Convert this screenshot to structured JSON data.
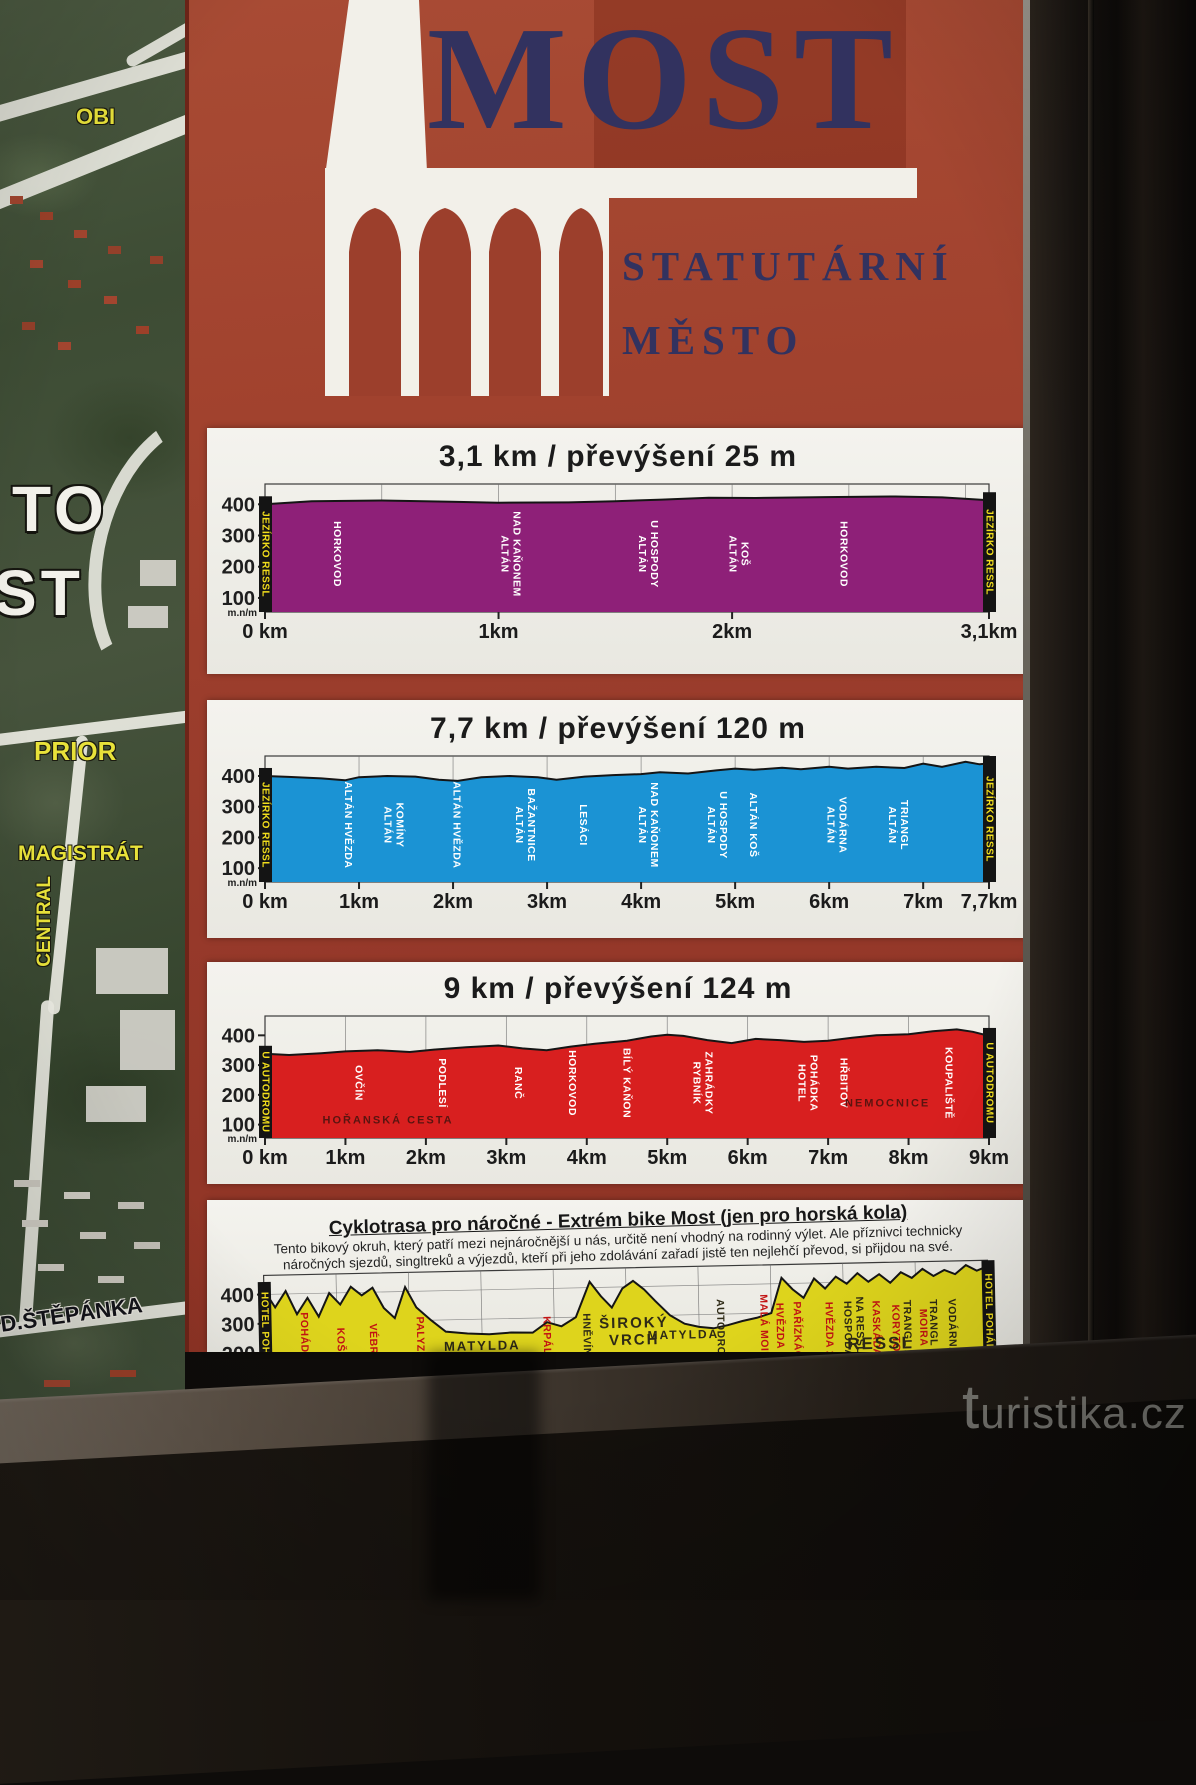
{
  "sign": {
    "logo": {
      "city": "MOST",
      "subtitle_line1": "STATUTÁRNÍ",
      "subtitle_line2": "MĚSTO",
      "background_color": "#9c3f2c",
      "text_color": "#32325f"
    }
  },
  "map": {
    "labels": [
      {
        "text": "OBI"
      },
      {
        "text": "PRIOR"
      },
      {
        "text": "MAGISTRÁT"
      },
      {
        "text": "CENTRAL"
      },
      {
        "text": "D.ŠTĚPÁNKA"
      },
      {
        "text": "TO"
      },
      {
        "text": "ST"
      }
    ]
  },
  "watermark": {
    "text": "turistika.cz"
  },
  "chart_data": [
    {
      "type": "area",
      "title": "3,1 km / převýšení 25 m",
      "length_km": 3.1,
      "elevation_gain_m": 25,
      "color": "#8e2078",
      "ylabel": "m.n/m",
      "yticks": [
        400,
        300,
        200,
        100
      ],
      "ylim": [
        55,
        465
      ],
      "x_max": 3.1,
      "grid_step": 0.5,
      "xticks": [
        [
          "0 km",
          0
        ],
        [
          "1km",
          1
        ],
        [
          "2km",
          2
        ],
        [
          "3,1km",
          3.1
        ]
      ],
      "marker_start": "JEZÍRKO RESSL",
      "marker_end": "JEZÍRKO RESSL",
      "profile": {
        "x": [
          0,
          0.2,
          0.5,
          0.8,
          1.0,
          1.3,
          1.5,
          1.7,
          1.9,
          2.1,
          2.4,
          2.7,
          2.9,
          3.1
        ],
        "elev": [
          400,
          410,
          412,
          408,
          405,
          406,
          410,
          415,
          421,
          420,
          423,
          425,
          422,
          413
        ]
      },
      "labels": [
        {
          "lines": [
            "HORKOVOD"
          ],
          "x": 0.1
        },
        {
          "lines": [
            "ALTÁN",
            "NAD KAŇONEM"
          ],
          "x": 0.34
        },
        {
          "lines": [
            "ALTÁN",
            "U HOSPODY"
          ],
          "x": 0.53
        },
        {
          "lines": [
            "ALTÁN",
            "KOŠ"
          ],
          "x": 0.655
        },
        {
          "lines": [
            "HORKOVOD"
          ],
          "x": 0.8
        }
      ]
    },
    {
      "type": "area",
      "title": "7,7 km / převýšení 120 m",
      "length_km": 7.7,
      "elevation_gain_m": 120,
      "color": "#1b93d4",
      "ylabel": "m.n/m",
      "yticks": [
        400,
        300,
        200,
        100
      ],
      "ylim": [
        55,
        465
      ],
      "x_max": 7.7,
      "grid_step": 1,
      "xticks": [
        [
          "0 km",
          0
        ],
        [
          "1km",
          1
        ],
        [
          "2km",
          2
        ],
        [
          "3km",
          3
        ],
        [
          "4km",
          4
        ],
        [
          "5km",
          5
        ],
        [
          "6km",
          6
        ],
        [
          "7km",
          7
        ],
        [
          "7,7km",
          7.7
        ]
      ],
      "marker_start": "JEZÍRKO RESSL",
      "marker_end": "JEZÍRKO RESSL",
      "profile": {
        "x": [
          0,
          0.25,
          0.6,
          0.85,
          1.0,
          1.3,
          1.6,
          1.85,
          2.05,
          2.3,
          2.6,
          2.9,
          3.1,
          3.4,
          3.7,
          4.0,
          4.2,
          4.5,
          4.8,
          5.0,
          5.2,
          5.5,
          5.7,
          6.0,
          6.2,
          6.5,
          6.8,
          7.0,
          7.2,
          7.45,
          7.6,
          7.7
        ],
        "elev": [
          400,
          397,
          392,
          386,
          396,
          400,
          398,
          388,
          384,
          396,
          400,
          396,
          388,
          398,
          403,
          406,
          412,
          408,
          418,
          424,
          420,
          427,
          422,
          430,
          424,
          430,
          426,
          440,
          430,
          446,
          438,
          441
        ]
      },
      "labels": [
        {
          "lines": [
            "ALTÁN HVĚZDA"
          ],
          "x": 0.115
        },
        {
          "lines": [
            "ALTÁN",
            "KOMÍNY"
          ],
          "x": 0.178
        },
        {
          "lines": [
            "ALTÁN HVĚZDA"
          ],
          "x": 0.265
        },
        {
          "lines": [
            "ALTÁN",
            "BAŽANTNICE"
          ],
          "x": 0.36
        },
        {
          "lines": [
            "LESÁCI"
          ],
          "x": 0.44
        },
        {
          "lines": [
            "ALTÁN",
            "NAD KAŇONEM"
          ],
          "x": 0.53
        },
        {
          "lines": [
            "ALTÁN",
            "U HOSPODY"
          ],
          "x": 0.625
        },
        {
          "lines": [
            "ALTÁN KOŠ"
          ],
          "x": 0.675
        },
        {
          "lines": [
            "ALTÁN",
            "VODÁRNA"
          ],
          "x": 0.79
        },
        {
          "lines": [
            "ALTÁN",
            "TRIANGL"
          ],
          "x": 0.875
        }
      ]
    },
    {
      "type": "area",
      "title": "9 km / převýšení 124 m",
      "length_km": 9,
      "elevation_gain_m": 124,
      "color": "#d81f1f",
      "ylabel": "m.n/m",
      "yticks": [
        400,
        300,
        200,
        100
      ],
      "ylim": [
        55,
        465
      ],
      "x_max": 9,
      "grid_step": 1,
      "xticks": [
        [
          "0 km",
          0
        ],
        [
          "1km",
          1
        ],
        [
          "2km",
          2
        ],
        [
          "3km",
          3
        ],
        [
          "4km",
          4
        ],
        [
          "5km",
          5
        ],
        [
          "6km",
          6
        ],
        [
          "7km",
          7
        ],
        [
          "8km",
          8
        ],
        [
          "9km",
          9
        ]
      ],
      "marker_start": "U AUTODROMU",
      "marker_end": "U AUTODROMU",
      "profile": {
        "x": [
          0,
          0.3,
          0.7,
          1.0,
          1.4,
          1.8,
          2.1,
          2.5,
          2.9,
          3.2,
          3.5,
          3.8,
          4.1,
          4.5,
          4.8,
          5.0,
          5.2,
          5.5,
          5.8,
          6.1,
          6.4,
          6.7,
          7.0,
          7.3,
          7.6,
          8.0,
          8.3,
          8.6,
          8.8,
          9.0
        ],
        "elev": [
          338,
          334,
          340,
          346,
          350,
          344,
          352,
          360,
          366,
          356,
          350,
          362,
          372,
          382,
          396,
          402,
          398,
          384,
          374,
          388,
          384,
          378,
          382,
          392,
          400,
          404,
          414,
          420,
          412,
          398
        ]
      },
      "labels": [
        {
          "lines": [
            "OVČÍN"
          ],
          "x": 0.13
        },
        {
          "lines": [
            "HOŘANSKÁ CESTA"
          ],
          "x": 0.17,
          "style": "darkred",
          "orient": "h",
          "y": 0.88,
          "fs": 11
        },
        {
          "lines": [
            "PODLESÍ"
          ],
          "x": 0.245
        },
        {
          "lines": [
            "RANČ"
          ],
          "x": 0.35
        },
        {
          "lines": [
            "HORKOVOD"
          ],
          "x": 0.425
        },
        {
          "lines": [
            "BÍLÝ KAŇON"
          ],
          "x": 0.5
        },
        {
          "lines": [
            "RYBNÍK",
            "ZAHRÁDKY"
          ],
          "x": 0.605
        },
        {
          "lines": [
            "HOTEL",
            "POHÁDKA"
          ],
          "x": 0.75
        },
        {
          "lines": [
            "HŘBITOV"
          ],
          "x": 0.8
        },
        {
          "lines": [
            "NEMOCNICE"
          ],
          "x": 0.86,
          "style": "darkred",
          "orient": "h",
          "y": 0.74,
          "fs": 11
        },
        {
          "lines": [
            "KOUPALIŠTĚ"
          ],
          "x": 0.945
        }
      ]
    },
    {
      "type": "area",
      "title": "Cyklotrasa pro náročné - Extrém bike Most (jen pro horská kola)",
      "desc_line1": "Tento bikový okruh, který patří mezi nejnáročnější u nás, určitě není vhodný na rodinný výlet. Ale příznivci technicky",
      "desc_line2": "náročných sjezdů, singltreků a výjezdů, kteří při jeho zdolávání zařadí jistě ten nejlehčí převod, si přijdou na své.",
      "color": "#ded41c",
      "ylabel": "m.n/m",
      "yticks": [
        400,
        300,
        200,
        100
      ],
      "ylim": [
        55,
        465
      ],
      "x_max": 100,
      "grid_step": 10,
      "hgrid": true,
      "xticks": [],
      "marker_start": "HOTEL POHÁDKA",
      "marker_end": "HOTEL POHÁDKA",
      "profile": {
        "x": [
          0,
          1.5,
          3,
          4.5,
          6,
          7.5,
          9,
          10.5,
          12,
          13.5,
          15,
          16.5,
          18,
          19.5,
          21,
          23,
          25,
          28,
          31,
          34,
          37,
          39,
          41,
          43,
          45,
          46.5,
          48,
          49.5,
          51,
          52.5,
          54,
          56,
          58,
          60,
          62,
          64,
          66,
          68,
          70,
          71.5,
          73,
          74.5,
          76,
          77.5,
          79,
          80.5,
          82,
          83.5,
          85,
          86.5,
          88,
          89.5,
          91,
          92.5,
          94,
          95.5,
          97,
          98.5,
          100
        ],
        "elev": [
          415,
          355,
          410,
          330,
          385,
          320,
          400,
          360,
          420,
          390,
          415,
          345,
          310,
          415,
          345,
          300,
          260,
          252,
          248,
          252,
          250,
          285,
          270,
          300,
          420,
          370,
          330,
          395,
          420,
          390,
          350,
          300,
          270,
          258,
          252,
          262,
          275,
          285,
          300,
          420,
          380,
          350,
          415,
          380,
          420,
          395,
          430,
          400,
          425,
          395,
          430,
          410,
          440,
          415,
          435,
          420,
          450,
          430,
          445
        ]
      },
      "labels": [
        {
          "lines": [
            "POHÁDKA"
          ],
          "x": 0.055,
          "style": "red"
        },
        {
          "lines": [
            "KOŠ"
          ],
          "x": 0.105,
          "style": "red"
        },
        {
          "lines": [
            "VÉBR"
          ],
          "x": 0.15,
          "style": "red"
        },
        {
          "lines": [
            "PALYZA"
          ],
          "x": 0.215,
          "style": "red"
        },
        {
          "lines": [
            "RESSL"
          ],
          "x": 0.17,
          "style": "dark",
          "orient": "h",
          "y": 0.82,
          "ul": 0.27,
          "fs": 17
        },
        {
          "lines": [
            "MATYLDA"
          ],
          "x": 0.3,
          "style": "dark",
          "orient": "h",
          "y": 0.66,
          "fs": 13
        },
        {
          "lines": [
            "KRPÁL"
          ],
          "x": 0.39,
          "style": "red"
        },
        {
          "lines": [
            "HNĚVÍN"
          ],
          "x": 0.445,
          "style": "dark"
        },
        {
          "lines": [
            "ŠIROKÝ",
            "VRCH"
          ],
          "x": 0.51,
          "style": "dark",
          "orient": "h",
          "y": 0.5,
          "fs": 15
        },
        {
          "lines": [
            "MATYLDA"
          ],
          "x": 0.578,
          "style": "dark",
          "orient": "h",
          "y": 0.6,
          "fs": 12
        },
        {
          "lines": [
            "AUTODROM"
          ],
          "x": 0.63,
          "style": "dark"
        },
        {
          "lines": [
            "MALÁ MOIRA"
          ],
          "x": 0.69,
          "style": "red"
        },
        {
          "lines": [
            "HVĚZDA 1"
          ],
          "x": 0.712,
          "style": "red"
        },
        {
          "lines": [
            "PAŘÍZKÁČ"
          ],
          "x": 0.736,
          "style": "red"
        },
        {
          "lines": [
            "HVĚZDA 2"
          ],
          "x": 0.78,
          "style": "red"
        },
        {
          "lines": [
            "HOSPODA",
            "NA RESSLU"
          ],
          "x": 0.814,
          "style": "dark"
        },
        {
          "lines": [
            "KASKÁDA"
          ],
          "x": 0.845,
          "style": "red"
        },
        {
          "lines": [
            "KORYTO"
          ],
          "x": 0.872,
          "style": "red"
        },
        {
          "lines": [
            "TRANGL 1"
          ],
          "x": 0.888,
          "style": "dark"
        },
        {
          "lines": [
            "MOIRA"
          ],
          "x": 0.91,
          "style": "red"
        },
        {
          "lines": [
            "TRANGL 2"
          ],
          "x": 0.924,
          "style": "dark"
        },
        {
          "lines": [
            "VODÁRNA"
          ],
          "x": 0.95,
          "style": "dark"
        },
        {
          "lines": [
            "RESSL"
          ],
          "x": 0.85,
          "style": "dark",
          "orient": "h",
          "y": 0.72,
          "ul": 0.25,
          "fs": 17
        }
      ]
    }
  ]
}
